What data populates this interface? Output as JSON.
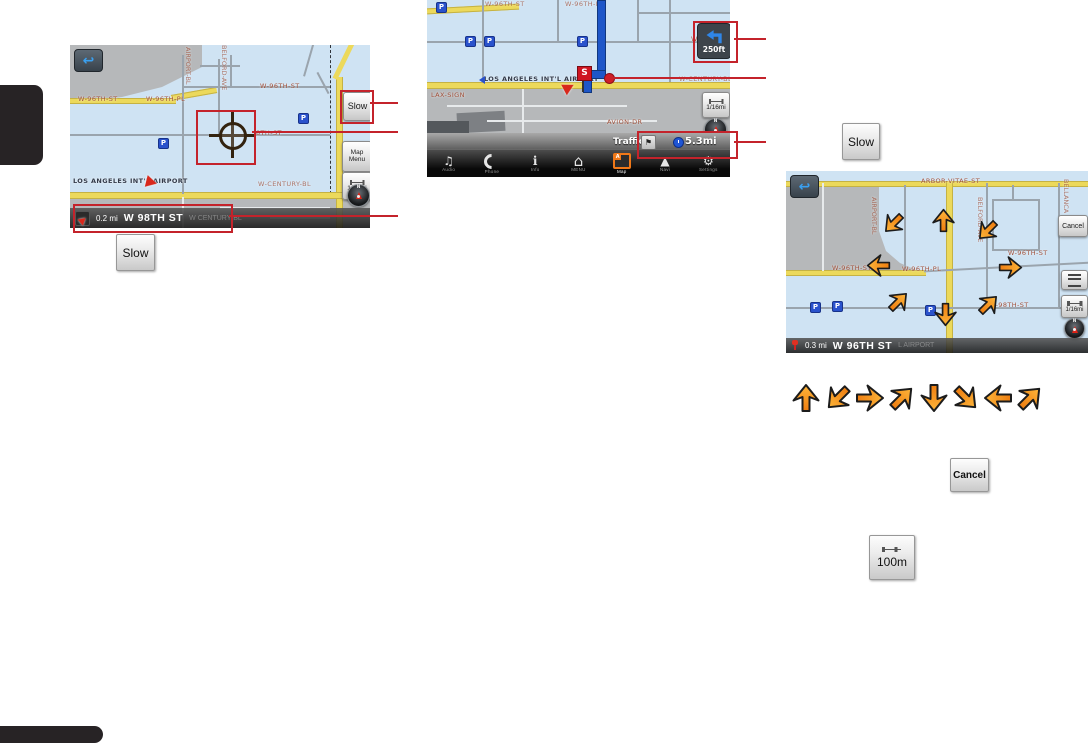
{
  "ui": {
    "back_glyph": "↩",
    "compass_n": "N",
    "parking_glyph": "P",
    "scale_1_16": "1/16mi",
    "callout_color": "#c4232b"
  },
  "figure1": {
    "streets": [
      "W-96TH-ST",
      "W-96TH-PL",
      "W-96TH-ST",
      "8TH-ST",
      "LOS ANGELES INT'L AIRPORT",
      "W-CENTURY-BL",
      "AIRPORT-BL",
      "BELFORD-AVE"
    ],
    "slow_button": "Slow",
    "map_menu_line1": "Map",
    "map_menu_line2": "Menu",
    "bottom_bar": {
      "distance": "0.2 mi",
      "street": "W 98TH ST",
      "ghost": "W CENTURY BL"
    }
  },
  "figure2": {
    "turn_distance": "250ft",
    "streets": [
      "W-96TH-ST",
      "W-96TH-PL",
      "W-98TH-ST",
      "LOS ANGELES INT'L AIRPORT",
      "LAX-SIGN",
      "W-CENTURY-BL",
      "AVION-DR"
    ],
    "flag_label": "S",
    "status": {
      "traffic_label": "Traffic",
      "flag_glyph": "⚑",
      "distance": "5.3mi"
    },
    "navbar": [
      {
        "glyph": "♫",
        "label": "Audio"
      },
      {
        "glyph": "",
        "label": "Phone"
      },
      {
        "glyph": "i",
        "label": "Info"
      },
      {
        "glyph": "⌂",
        "label": "MENU"
      },
      {
        "glyph": "A",
        "label": "Map"
      },
      {
        "glyph": "▲",
        "label": "Navi"
      },
      {
        "glyph": "⚙",
        "label": "Settings"
      }
    ]
  },
  "figure3": {
    "cancel_button": "Cancel",
    "streets": [
      "ARBOR-VITAE-ST",
      "BELLANCA",
      "BELFORD-AVE",
      "AIRPORT-BL",
      "W-96TH-ST",
      "W-96TH-ST",
      "W-96TH-PL",
      "W-98TH-ST"
    ],
    "bottom_bar": {
      "distance": "0.3 mi",
      "street": "W 96TH ST",
      "ghost": "L AIRPORT"
    },
    "arrows": {
      "directions": [
        "down-left",
        "up",
        "down-left",
        "left",
        "right",
        "up-right",
        "down",
        "up-right"
      ],
      "rotations": [
        225,
        0,
        225,
        270,
        90,
        45,
        180,
        45
      ]
    }
  },
  "arrow_row": {
    "directions": [
      "up",
      "down-left",
      "right",
      "up-right",
      "down",
      "down-right",
      "left",
      "up-right"
    ],
    "rotations": [
      0,
      225,
      90,
      45,
      180,
      135,
      270,
      45
    ]
  },
  "inline_buttons": {
    "slow": "Slow",
    "cancel": "Cancel",
    "scale_100m": "100m"
  }
}
